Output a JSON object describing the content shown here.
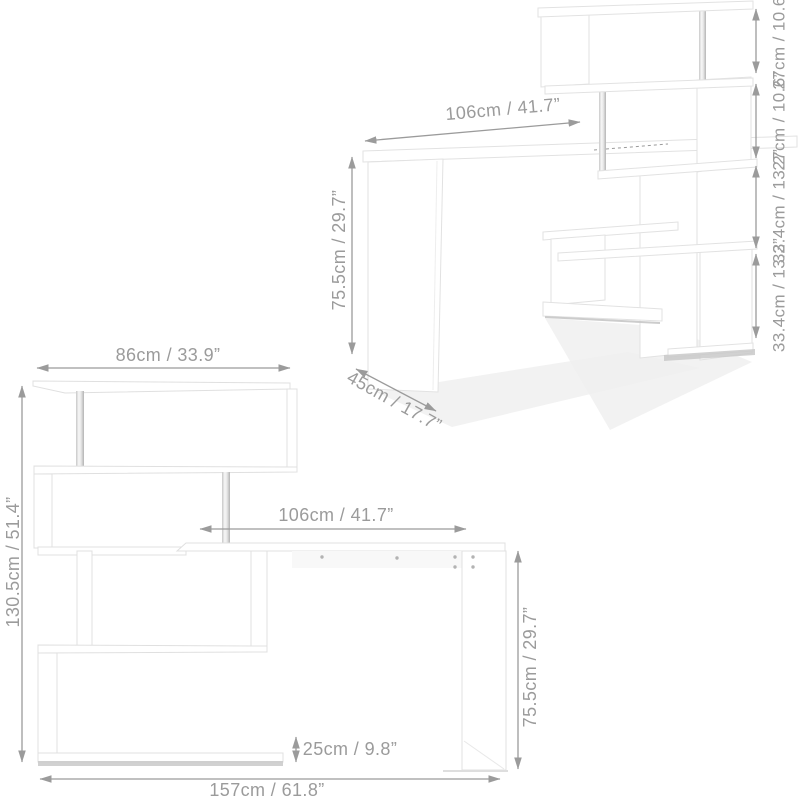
{
  "page": {
    "background": "#ffffff",
    "dimension_color": "#9b9b9b",
    "furniture_fill": "#ffffff",
    "furniture_edge_color": "#e2e2e2",
    "floor_shadow_color": "#c9c9c9"
  },
  "view_3d": {
    "desktop_width": "106cm / 41.7”",
    "desk_height": "75.5cm / 29.7”",
    "desk_depth": "45cm / 17.7”",
    "shelf_segments": [
      {
        "cm": "27cm",
        "inch": "/ 10.6”"
      },
      {
        "cm": "27cm",
        "inch": "/ 10.6”"
      },
      {
        "cm": "33.4cm",
        "inch": "/ 13.2”"
      },
      {
        "cm": "33.4cm",
        "inch": "/ 13.2”"
      }
    ]
  },
  "view_front": {
    "top_shelf_width": "86cm / 33.9”",
    "total_height": "130.5cm / 51.4”",
    "desktop_width": "106cm / 41.7”",
    "desk_height": "75.5cm / 29.7”",
    "bottom_shelf_height": "25cm / 9.8”",
    "total_width": "157cm / 61.8”"
  }
}
